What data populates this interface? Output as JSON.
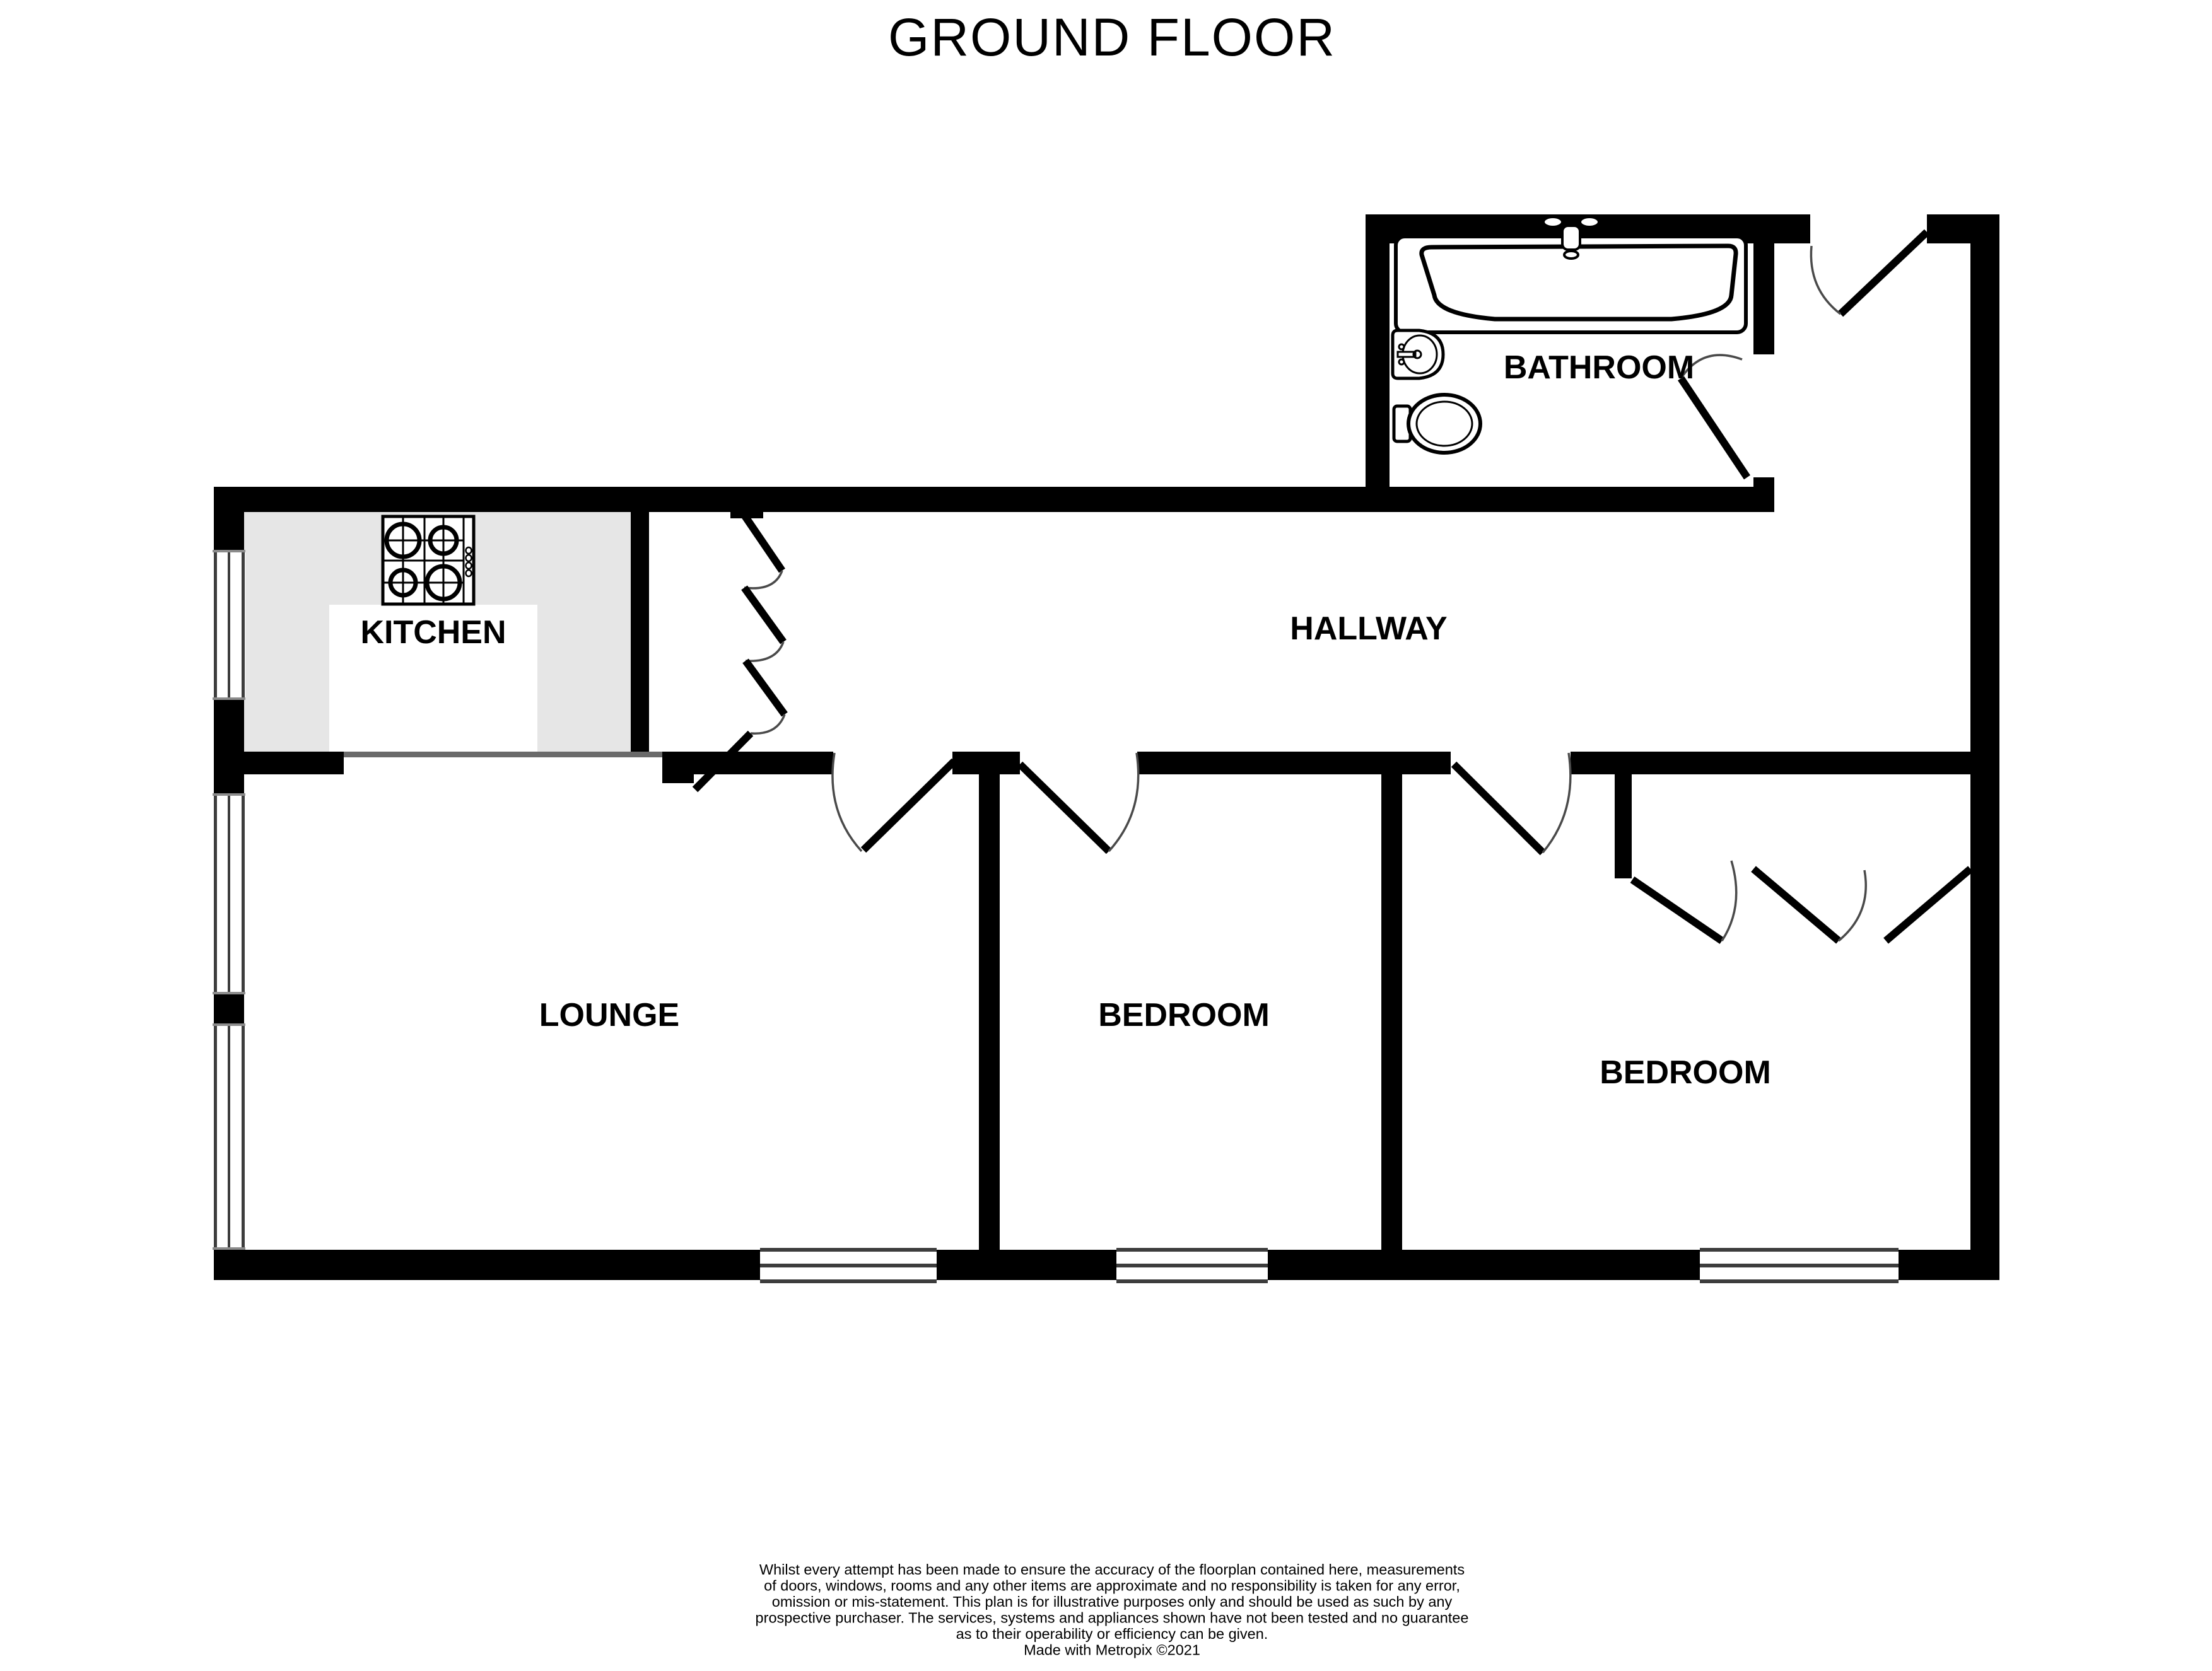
{
  "title": "GROUND FLOOR",
  "rooms": {
    "bathroom": {
      "label": "BATHROOM"
    },
    "kitchen": {
      "label": "KITCHEN"
    },
    "hallway": {
      "label": "HALLWAY"
    },
    "lounge": {
      "label": "LOUNGE"
    },
    "bedroom_middle": {
      "label": "BEDROOM"
    },
    "bedroom_right": {
      "label": "BEDROOM"
    }
  },
  "icons": {
    "bathtub": "bathtub-icon",
    "sink": "pedestal-sink-icon",
    "toilet": "toilet-icon",
    "stove": "stove-hob-icon",
    "doors": "door-swing-icon",
    "folding_door": "folding-door-icon",
    "windows": "window-icon"
  },
  "disclaimer": {
    "lines": [
      "Whilst every attempt has been made to ensure the accuracy of the floorplan contained here, measurements",
      "of doors, windows, rooms and any other items are approximate and no responsibility is taken for any error,",
      "omission or mis-statement. This plan is for illustrative purposes only and should be used as such by any",
      "prospective purchaser. The services, systems and appliances shown have not been tested and no guarantee",
      "as to their operability or efficiency can be given."
    ],
    "credit": "Made with Metropix ©2021"
  },
  "colors": {
    "wall": "#000000",
    "kitchen_counter": "#e6e6e6",
    "window_frame": "#3d3d3d",
    "arc": "#4a4a4a",
    "open_boundary": "#6a6a6a",
    "background": "#ffffff"
  }
}
